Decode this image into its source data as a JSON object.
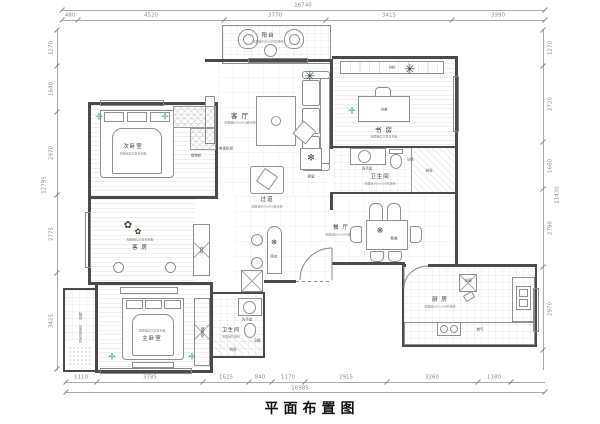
{
  "title": "平面布置图",
  "dims": {
    "top": {
      "total": "16740",
      "seg": [
        "480",
        "4520",
        "3770",
        "3415",
        "3990"
      ]
    },
    "bottom": {
      "total": "16985",
      "seg": [
        "1110",
        "3785",
        "1625",
        "840",
        "1170",
        "2915",
        "3260",
        "1180"
      ]
    },
    "left": {
      "total": "12795",
      "seg": [
        "1270",
        "1640",
        "2970",
        "2775",
        "3425"
      ]
    },
    "right": {
      "total": "11430",
      "seg": [
        "1270",
        "2720",
        "1680",
        "2790",
        "2970"
      ]
    }
  },
  "rooms": {
    "balconyTop": {
      "name": "阳台",
      "note": "地面铺300x300防滑砖"
    },
    "living": {
      "name": "客 厅",
      "note": "地面铺800x800玻化砖"
    },
    "study": {
      "name": "书 房",
      "note": "地面铺实木复合地板"
    },
    "bathRight": {
      "name": "卫生间",
      "note": "地面铺300x300防滑砖"
    },
    "dining": {
      "name": "餐 厅",
      "note": "地面铺800x800玻化砖"
    },
    "kitchen": {
      "name": "厨 房",
      "note": "地面铺300x300防滑砖"
    },
    "bedroom2": {
      "name": "次卧室",
      "note": "地面铺实木复合地板"
    },
    "guest": {
      "name": "客 房",
      "note": "地面铺实木复合地板"
    },
    "master": {
      "name": "主卧室",
      "note": "地面铺实木复合地板"
    },
    "balconyLeft": {
      "name": "阳台",
      "note": "地面铺防滑砖"
    },
    "bathBottom": {
      "name": "卫生间",
      "note": "地面铺防滑砖"
    },
    "corridor": {
      "name": "过道",
      "note": "地面铺800x800玻化砖"
    }
  },
  "items": {
    "tvCabinet": "电视机柜",
    "reserved": "预留",
    "bookcase": "书柜",
    "desk": "书桌",
    "basin": "洗手盆",
    "toilet": "马桶",
    "shower": "淋浴",
    "diningTable": "餐桌",
    "fridge": "冰箱",
    "gas": "燃气",
    "storage": "储物柜",
    "wardrobe": "衣柜",
    "bar": "吧台"
  }
}
